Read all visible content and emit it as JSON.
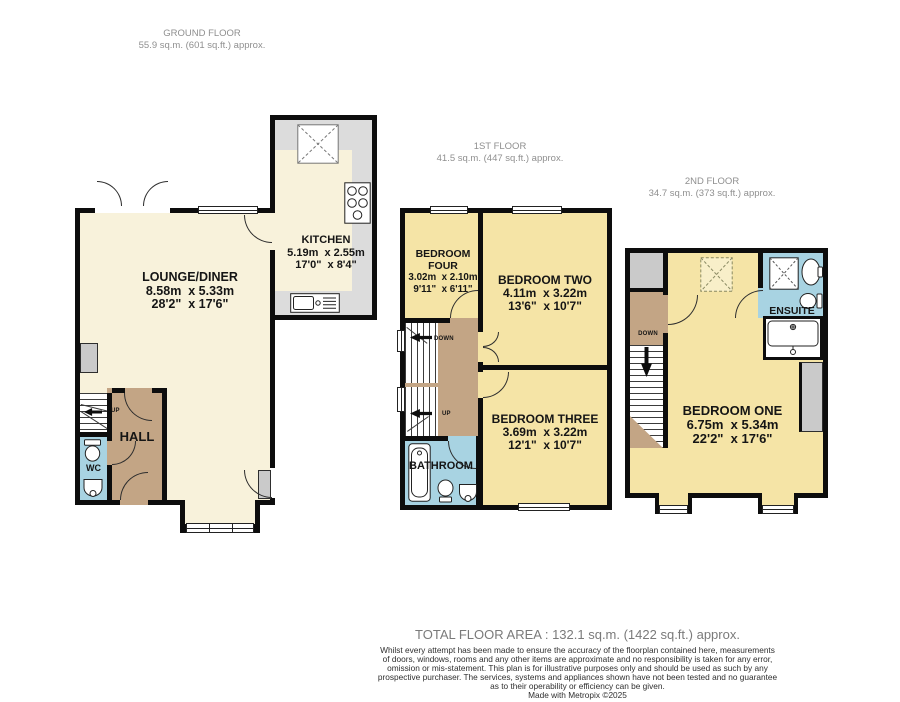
{
  "colors": {
    "wall": "#0d0d0d",
    "floor_cream": "#F8F2DB",
    "floor_yellow": "#F5E4A6",
    "landing_tan": "#C3A585",
    "wet_room_blue": "#A8D3E2",
    "counter_gray": "#DCDCDC",
    "storage_gray": "#CACACA"
  },
  "floors": {
    "ground": {
      "title": "GROUND FLOOR",
      "area": "55.9 sq.m. (601 sq.ft.) approx."
    },
    "first": {
      "title": "1ST FLOOR",
      "area": "41.5 sq.m. (447 sq.ft.) approx."
    },
    "second": {
      "title": "2ND FLOOR",
      "area": "34.7 sq.m. (373 sq.ft.) approx."
    }
  },
  "rooms": {
    "lounge_diner": {
      "name": "LOUNGE/DINER",
      "metric": "8.58m  x 5.33m",
      "imperial": "28'2\"  x 17'6\""
    },
    "kitchen": {
      "name": "KITCHEN",
      "metric": "5.19m  x 2.55m",
      "imperial": "17'0\"  x 8'4\""
    },
    "hall": {
      "name": "HALL"
    },
    "wc": {
      "name": "WC"
    },
    "bedroom_four": {
      "name": "BEDROOM FOUR",
      "metric": "3.02m  x 2.10m",
      "imperial": "9'11\"  x 6'11\""
    },
    "bedroom_two": {
      "name": "BEDROOM TWO",
      "metric": "4.11m  x 3.22m",
      "imperial": "13'6\"  x 10'7\""
    },
    "bedroom_three": {
      "name": "BEDROOM THREE",
      "metric": "3.69m  x 3.22m",
      "imperial": "12'1\"  x 10'7\""
    },
    "bathroom": {
      "name": "BATHROOM"
    },
    "bedroom_one": {
      "name": "BEDROOM ONE",
      "metric": "6.75m  x 5.34m",
      "imperial": "22'2\"  x 17'6\""
    },
    "ensuite": {
      "name": "ENSUITE"
    }
  },
  "stairs": {
    "up_label": "UP",
    "down_label": "DOWN"
  },
  "footer": {
    "total": "TOTAL FLOOR AREA : 132.1 sq.m. (1422 sq.ft.) approx.",
    "lines": [
      "Whilst every attempt has been made to ensure the accuracy of the floorplan contained here, measurements",
      "of doors, windows, rooms and any other items are approximate and no responsibility is taken for any error,",
      "omission or mis-statement. This plan is for illustrative purposes only and should be used as such by any",
      "prospective purchaser. The services, systems and appliances shown have not been tested and no guarantee",
      "as to their operability or efficiency can be given.",
      "Made with Metropix ©2025"
    ]
  }
}
